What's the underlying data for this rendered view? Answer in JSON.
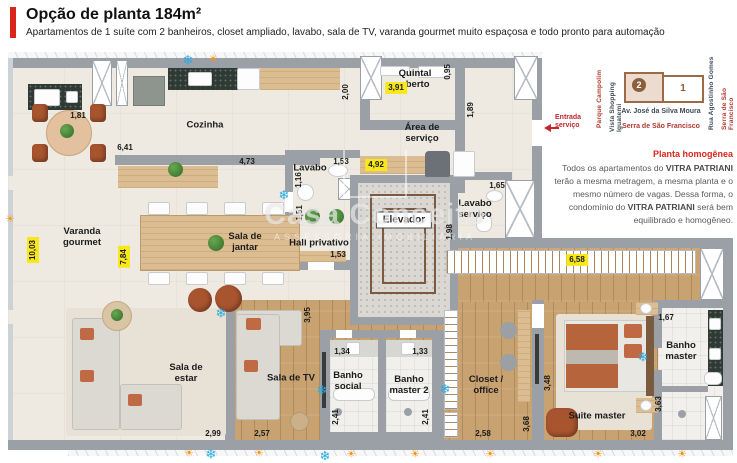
{
  "header": {
    "title": "Opção de planta 184m²",
    "subtitle": "Apartamentos de 1 suíte com 2 banheiros, closet ampliado, lavabo, sala de TV, varanda gourmet muito espaçosa e todo pronto para automação"
  },
  "colors": {
    "accent_red": "#d9251c",
    "highlight_yellow": "#f8e71c",
    "snowflake_blue": "#29abe2",
    "sun_orange": "#f7941d",
    "map_brown": "#9c6b45"
  },
  "icons": {
    "snowflake": "❄",
    "sun": "☀",
    "compass_sun": "☀"
  },
  "plan": {
    "rooms": {
      "varanda_gourmet": "Varanda gourmet",
      "cozinha": "Cozinha",
      "quintal_aberto": "Quintal aberto",
      "area_servico": "Área de serviço",
      "lavabo": "Lavabo",
      "lavabo_servico": "Lavabo serviço",
      "hall_privativo": "Hall privativo",
      "elevador": "Elevador",
      "sala_jantar": "Sala de jantar",
      "sala_estar": "Sala de estar",
      "sala_tv": "Sala de TV",
      "banho_social": "Banho social",
      "banho_master2": "Banho master 2",
      "closet_office": "Closet / office",
      "suite_master": "Suite master",
      "banho_master": "Banho master"
    },
    "measurements": {
      "varanda_counter": "1,81",
      "cozinha_len": "6,41",
      "cozinha_dep": "2,00",
      "cozinha_bottom": "4,73",
      "quintal_w": "3,91",
      "quintal_d": "0,95",
      "servico_d": "1,89",
      "lavabo_w": "1,53",
      "lavabo_d": "1,16",
      "hall_elev": "4,92",
      "lavabo_servico_w": "1,65",
      "lavabo_servico_d": "1,98",
      "hall_d": "1,51",
      "hall_w": "1,53",
      "varanda_len": "10,03",
      "varanda_int": "7,84",
      "closet_corridor": "6,58",
      "sala_tv_d": "3,95",
      "banho_social_w": "1,34",
      "banho_master2_w": "1,33",
      "banho_social_d": "2,41",
      "banho_master2_d": "2,41",
      "sala_estar_w": "2,99",
      "sala_tv_w": "2,57",
      "closet_w": "2,58",
      "suite_d1": "3,68",
      "suite_w": "3,02",
      "suite_d2": "3,48",
      "banho_master_w": "1,67",
      "banho_master_d": "3,63"
    }
  },
  "annotations": {
    "entrada_line1": "Entrada",
    "entrada_line2": "serviço",
    "watermark_name": "Casa Conceito",
    "watermark_tag": "ASSESSORIA IMOBILIÁRIA"
  },
  "minimap": {
    "street_left1": "Parque Campolim",
    "street_left2": "Vista Shopping Iguatemi",
    "street_right1": "Rua Agostinho Gomes",
    "street_right2": "Serra de São Francisco",
    "street_bottom1": "Av. José da Silva Moura",
    "street_bottom2": "Serra de São Francisco",
    "tower1": "1",
    "tower2": "2"
  },
  "info": {
    "title": "Planta homogênea",
    "body_parts": [
      "Todos os apartamentos do ",
      "VITRA PATRIANI",
      " terão a mesma metragem, a mesma planta e o mesmo número de vagas. Dessa forma, o condomínio do ",
      "VITRA PATRIANI",
      " será bem equilibrado e homogêneo."
    ]
  }
}
